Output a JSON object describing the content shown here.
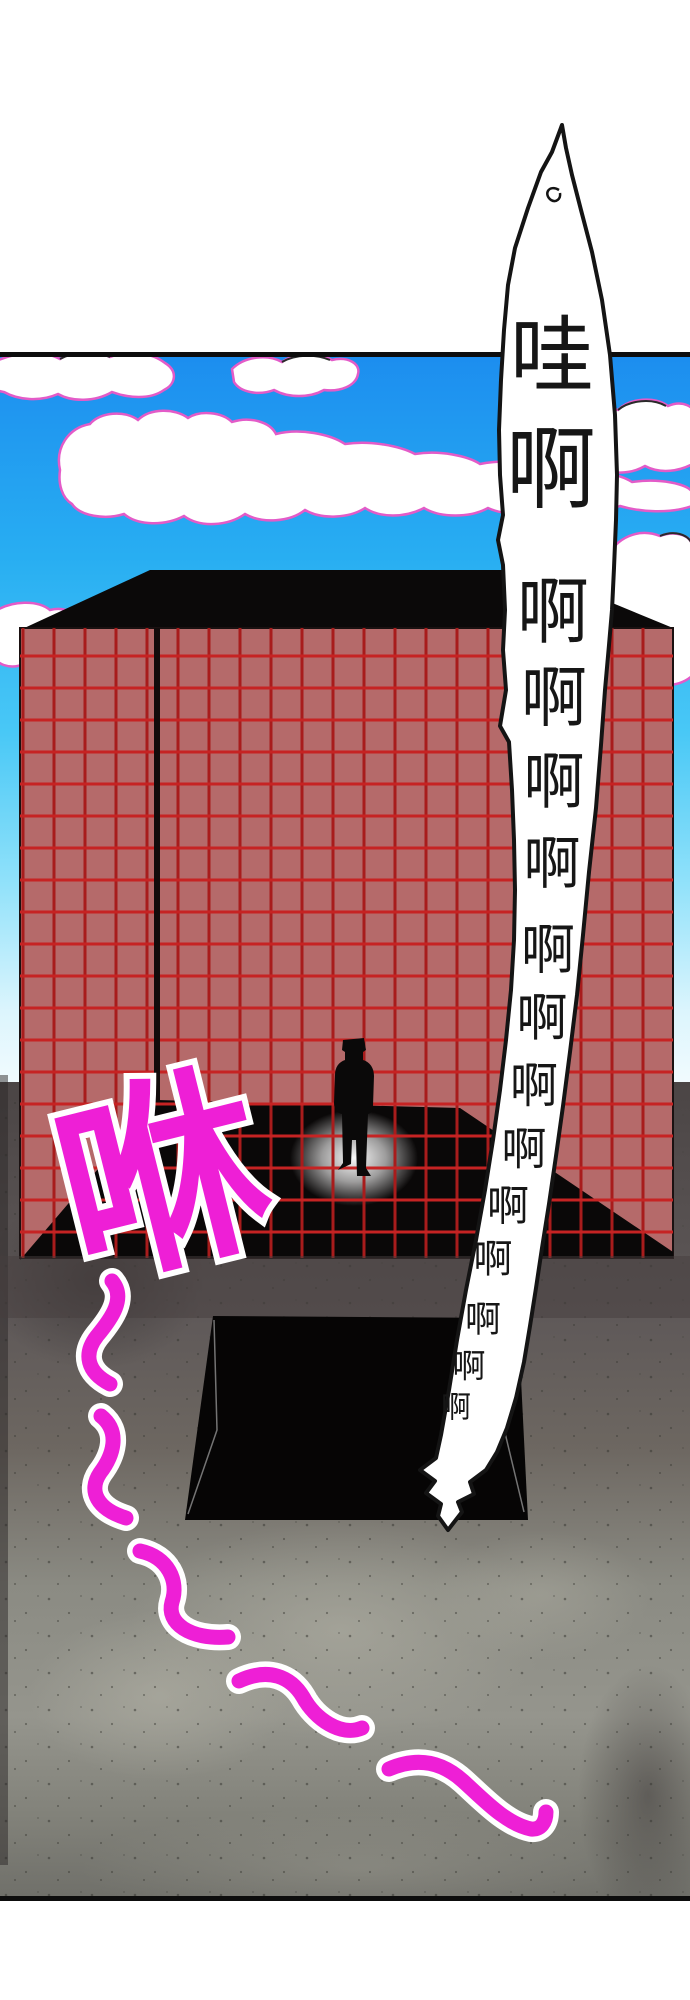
{
  "page": {
    "width": 690,
    "height": 2000,
    "background_color": "#ffffff"
  },
  "panel": {
    "border_color": "#0d0d0d",
    "top_border_y": 352,
    "bottom_border_y": 1896
  },
  "sky": {
    "gradient_top": "#1c8def",
    "gradient_mid": "#49c8f6",
    "gradient_bottom": "#f2fbfe",
    "top": 352,
    "bottom": 1085
  },
  "clouds": {
    "fill": "#ffffff",
    "outline_color": "#e35bc8",
    "accent_color": "#2a2a2a",
    "paths": [
      "M-6,362 C20,350 45,351 60,359 C75,349 95,349 110,357 C130,349 152,353 165,363 C178,371 176,384 164,390 C150,400 128,398 112,392 C95,402 72,402 58,394 C40,402 18,400 4,392 L-6,390 Z",
      "M232,369 C245,356 268,354 282,362 C296,352 318,352 332,360 C348,356 361,364 358,374 C356,386 340,392 324,390 C310,398 288,398 274,390 C258,396 240,392 234,382 Z",
      "M570,432 C577,412 600,404 618,410 C630,398 655,396 668,406 C682,400 696,406 696,418 L696,462 C680,472 660,474 645,466 C628,476 605,474 592,464 C578,464 568,452 570,440 Z",
      "M60,470 C55,448 68,428 90,424 C100,412 125,410 138,420 C150,408 175,408 188,418 C200,410 222,412 232,422 C250,416 270,422 276,434 C300,428 330,434 345,444 C370,440 400,446 415,454 C440,450 468,456 480,464 C510,458 545,464 560,472 C590,468 620,474 632,482 C660,478 688,484 692,492 L692,506 C670,514 640,512 620,506 C600,514 570,514 552,506 C535,516 505,516 488,508 C470,518 440,518 424,508 C405,518 380,518 365,508 C350,518 322,520 305,510 C290,522 262,524 245,514 C228,526 200,528 184,516 C165,526 138,526 124,514 C105,520 80,516 72,504 C62,498 58,484 60,470 Z",
      "M-6,612 C12,600 38,600 50,610 C66,606 80,614 78,628 C76,640 62,646 50,642 C52,656 40,666 24,664 C10,670 -6,664 -6,654 Z",
      "M606,560 C616,536 640,528 660,536 C676,530 692,536 692,546 L692,676 C678,688 655,688 642,678 C628,686 610,682 606,670 C598,658 600,646 610,640 C600,630 598,600 606,588 Z"
    ],
    "accents": [
      "M60,359 C75,351 95,351 110,357",
      "M282,362 C296,354 316,354 330,360",
      "M618,410 C630,400 652,398 666,406",
      "M660,536 C674,530 688,534 692,544"
    ]
  },
  "building": {
    "facade_color": "#b56a6a",
    "roof_color": "#0b0909",
    "shadow_color": "#0a0808",
    "grid_vertical_color": "#a81c1c",
    "grid_horizontal_color": "#c62323",
    "corner_color": "#120b0b",
    "left": 20,
    "right": 673,
    "top": 628,
    "bottom": 1258,
    "grid_start_x": 23,
    "grid_step_x": 31,
    "grid_start_y": 656,
    "grid_step_y": 32,
    "roof_path": "M20,630 L150,570 L505,570 L610,602 L673,628 L673,632 L20,632 Z",
    "shadow_points": "20,1260 157,1100 460,1108 673,1252 673,1258 20,1258"
  },
  "figure": {
    "color": "#0a0909",
    "path": "M343,1040 L364,1038 L366,1050 L363,1052 L363,1060 C370,1062 374,1068 374,1076 L373,1106 C373,1111 371,1113 368,1114 L367,1140 L366,1168 L371,1176 L357,1176 L356,1140 L352,1140 L351,1164 L338,1170 L343,1163 L342,1114 C337,1113 334,1109 334,1103 L335,1075 C335,1067 339,1062 345,1060 L345,1052 L342,1050 Z"
  },
  "glow": {
    "color": "#ffffff",
    "cx": 354,
    "cy": 1158,
    "rx": 64,
    "ry": 48
  },
  "pit": {
    "color": "#060505",
    "points": "213,1316 518,1318 528,1520 185,1520",
    "edge_line_color": "#cfcfcf",
    "edge_lines": [
      "214,1320 217,1430 188,1514",
      "500,1412 524,1512"
    ]
  },
  "ground": {
    "top_color": "#4b4545",
    "mid_color": "#6d6761",
    "light_color": "#95958d",
    "bottom_color": "#70706a",
    "speckle_color": "#34342f"
  },
  "scream_bubble": {
    "full_text": "哇啊啊啊啊啊啊啊啊啊啊啊啊啊啊",
    "fill": "#ffffff",
    "outline_color": "#141414",
    "text_color": "#161616",
    "points": "562,125 552,152 541,172 528,208 515,248 508,285 504,330 501,380 499,430 500,475 503,515 498,540 503,565 505,610 503,650 506,690 500,726 509,742 512,790 514,840 515,890 514,940 511,990 506,1040 500,1090 493,1140 485,1190 476,1240 466,1290 457,1340 449,1390 441,1435 436,1458 420,1470 435,1481 426,1493 441,1504 438,1516 448,1530 462,1512 458,1502 474,1494 470,1482 486,1470 497,1452 507,1428 516,1398 524,1362 530,1326 536,1288 542,1248 549,1204 556,1156 563,1106 570,1052 577,995 583,935 589,872 596,808 601,745 605,690 609,645 612,610 614,568 616,520 617,475 615,415 610,355 602,300 592,252 581,210 572,175 566,148",
    "tail_hook_path": "M559,190 C549,184 543,194 551,200 C556,203 561,199 560,193",
    "chars": [
      {
        "ch": "哇",
        "x": 552,
        "y": 356,
        "size": 84
      },
      {
        "ch": "啊",
        "x": 551,
        "y": 470,
        "size": 90
      },
      {
        "ch": "啊",
        "x": 553,
        "y": 612,
        "size": 72
      },
      {
        "ch": "啊",
        "x": 554,
        "y": 698,
        "size": 66
      },
      {
        "ch": "啊",
        "x": 554,
        "y": 782,
        "size": 61
      },
      {
        "ch": "啊",
        "x": 552,
        "y": 864,
        "size": 57
      },
      {
        "ch": "啊",
        "x": 548,
        "y": 950,
        "size": 54
      },
      {
        "ch": "啊",
        "x": 542,
        "y": 1019,
        "size": 51
      },
      {
        "ch": "啊",
        "x": 534,
        "y": 1086,
        "size": 48
      },
      {
        "ch": "啊",
        "x": 524,
        "y": 1149,
        "size": 45
      },
      {
        "ch": "啊",
        "x": 508,
        "y": 1206,
        "size": 42
      },
      {
        "ch": "啊",
        "x": 493,
        "y": 1260,
        "size": 39
      },
      {
        "ch": "啊",
        "x": 483,
        "y": 1320,
        "size": 36
      },
      {
        "ch": "啊",
        "x": 469,
        "y": 1366,
        "size": 33
      },
      {
        "ch": "啊",
        "x": 456,
        "y": 1408,
        "size": 30
      }
    ]
  },
  "sfx": {
    "text": "咻",
    "color": "#ee1fd6",
    "outline_color": "#ffffff",
    "x": 163,
    "y": 1180,
    "size": 205,
    "rotation": -14
  },
  "motion_trails": {
    "color": "#ee1fd6",
    "outline_color": "#ffffff",
    "paths": [
      "M112,1281 C126,1298 112,1318 97,1336 C83,1354 87,1372 110,1384",
      "M101,1416 C121,1432 113,1456 100,1473 C88,1491 97,1509 126,1518",
      "M140,1551 C168,1557 179,1581 172,1602 C166,1623 190,1640 228,1637",
      "M239,1681 C269,1667 291,1677 303,1697 C315,1719 341,1737 362,1728",
      "M389,1769 C419,1756 443,1763 463,1781 C483,1799 506,1824 531,1829 C541,1830 546,1822 546,1812"
    ]
  }
}
